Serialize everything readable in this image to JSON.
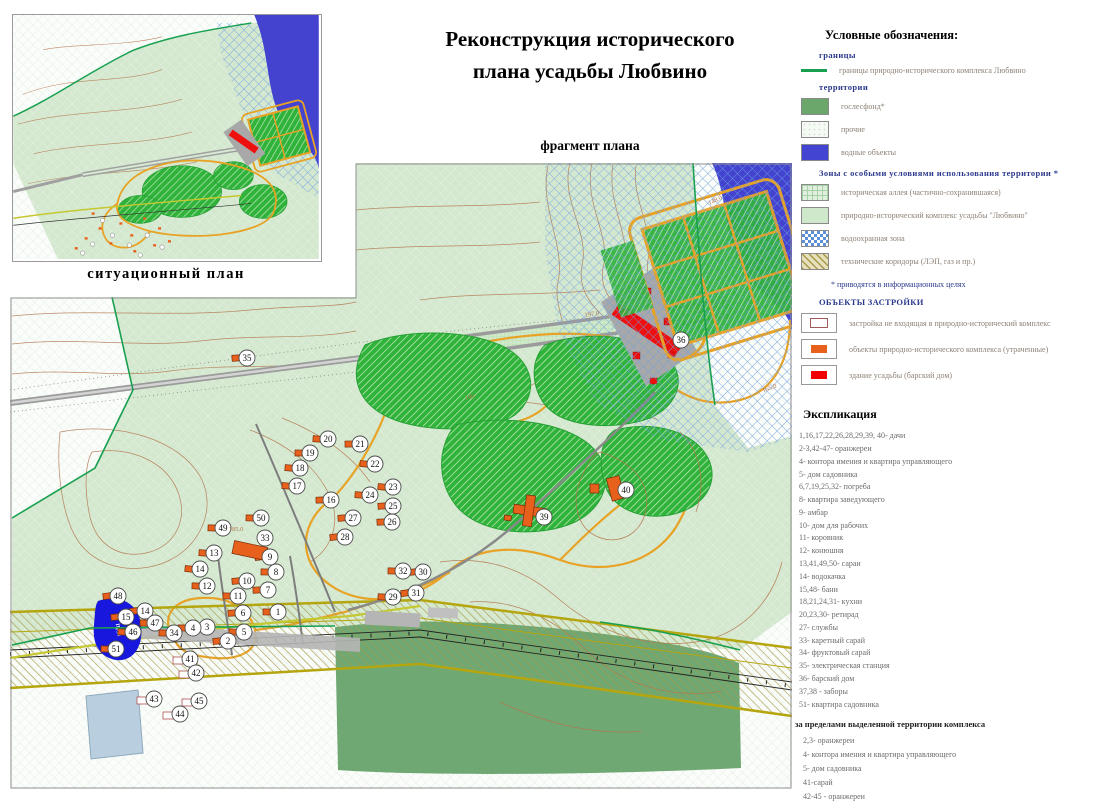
{
  "title": {
    "line1": "Реконструкция исторического",
    "line2": "плана усадьбы Любвино"
  },
  "fragment_label": "фрагмент плана",
  "inset": {
    "caption": "ситуационный план"
  },
  "legend": {
    "title": "Условные обозначения:",
    "sections": [
      {
        "heading": "границы",
        "items": [
          {
            "swatch": "line-green",
            "label": "границы природно-исторического комплекса Любвино"
          }
        ]
      },
      {
        "heading": "территории",
        "items": [
          {
            "swatch": "solid-green",
            "label": "гослесфонд*"
          },
          {
            "swatch": "dotted-white",
            "label": "прочие"
          },
          {
            "swatch": "solid-blue",
            "label": "водные объекты"
          }
        ]
      },
      {
        "heading": "Зоны с особыми условиями использования территории *",
        "items": [
          {
            "swatch": "grid-lightgreen",
            "label": "историческая аллея (частично-сохранившаяся)"
          },
          {
            "swatch": "solid-lightgreen",
            "label": "природно-исторический комплекс усадьбы \"Любвино\""
          },
          {
            "swatch": "checker-blue",
            "label": "водоохранная зона"
          },
          {
            "swatch": "hatch-olive",
            "label": "технические коридоры (ЛЭП, газ и пр.)"
          }
        ]
      }
    ],
    "note": "*   приводятся в информационных целях",
    "objects_heading": "ОБЪЕКТЫ ЗАСТРОЙКИ",
    "objects": [
      {
        "swatch": "box-outline",
        "label": "застройка не входящая в природно-исторический комплекс"
      },
      {
        "swatch": "box-orange",
        "label": "объекты природно-исторического комплекса (утраченные)"
      },
      {
        "swatch": "box-red",
        "label": "здание усадьбы (барский дом)"
      }
    ]
  },
  "explication": {
    "title": "Экспликация",
    "items": [
      "1,16,17,22,26,28,29,39, 40- дачи",
      "2-3,42-47-  оранжереи",
      "4- контора имения и квартира управляющего",
      "5- дом садовника",
      "6,7,19,25,32- погреба",
      "8- квартира заведующего",
      "9- амбар",
      "10- дом для рабочих",
      "11- коровник",
      "12- конюшня",
      "13,41,49,50- сараи",
      "14-  водокачка",
      "15,48- бани",
      "18,21,24,31- кухни",
      "20,23,30- ретирад",
      "27- службы",
      "33- каретный сарай",
      "34- фруктовый сарай",
      "35- электрическая станция",
      "36- барский дом",
      "37,38 - заборы",
      "51- квартира садовника"
    ],
    "outside_heading": "за пределами выделенной территории комплекса",
    "outside_items": [
      "2,3- оранжереи",
      "4- контора имения и квартира управляющего",
      "5- дом садовника",
      "41-сарай",
      "42-45 - оранжереи"
    ]
  },
  "map": {
    "pond_label": "Пруд",
    "contour_labels": [
      {
        "t": "197.0",
        "x": 592,
        "y": 316,
        "r": -8
      },
      {
        "t": "148.0",
        "x": 716,
        "y": 202,
        "r": -25
      },
      {
        "t": "165.0",
        "x": 770,
        "y": 390,
        "r": -20
      },
      {
        "t": "185.0",
        "x": 236,
        "y": 531,
        "r": 0
      },
      {
        "t": "190",
        "x": 470,
        "y": 399,
        "r": -10
      }
    ],
    "markers": [
      {
        "n": "1",
        "x": 278,
        "y": 612
      },
      {
        "n": "2",
        "x": 228,
        "y": 641
      },
      {
        "n": "3",
        "x": 207,
        "y": 627
      },
      {
        "n": "4",
        "x": 193,
        "y": 628
      },
      {
        "n": "5",
        "x": 244,
        "y": 632
      },
      {
        "n": "6",
        "x": 243,
        "y": 613
      },
      {
        "n": "7",
        "x": 268,
        "y": 590
      },
      {
        "n": "8",
        "x": 276,
        "y": 572
      },
      {
        "n": "9",
        "x": 270,
        "y": 557
      },
      {
        "n": "10",
        "x": 247,
        "y": 581
      },
      {
        "n": "11",
        "x": 238,
        "y": 596
      },
      {
        "n": "12",
        "x": 207,
        "y": 586
      },
      {
        "n": "13",
        "x": 214,
        "y": 553
      },
      {
        "n": "14",
        "x": 200,
        "y": 569
      },
      {
        "n": "14",
        "x": 145,
        "y": 611
      },
      {
        "n": "15",
        "x": 126,
        "y": 617
      },
      {
        "n": "16",
        "x": 331,
        "y": 500
      },
      {
        "n": "17",
        "x": 297,
        "y": 486
      },
      {
        "n": "18",
        "x": 300,
        "y": 468
      },
      {
        "n": "19",
        "x": 310,
        "y": 453
      },
      {
        "n": "20",
        "x": 328,
        "y": 439
      },
      {
        "n": "21",
        "x": 360,
        "y": 444
      },
      {
        "n": "22",
        "x": 375,
        "y": 464
      },
      {
        "n": "23",
        "x": 393,
        "y": 487
      },
      {
        "n": "24",
        "x": 370,
        "y": 495
      },
      {
        "n": "25",
        "x": 393,
        "y": 506
      },
      {
        "n": "26",
        "x": 392,
        "y": 522
      },
      {
        "n": "27",
        "x": 353,
        "y": 518
      },
      {
        "n": "28",
        "x": 345,
        "y": 537
      },
      {
        "n": "29",
        "x": 393,
        "y": 597
      },
      {
        "n": "30",
        "x": 423,
        "y": 572
      },
      {
        "n": "31",
        "x": 416,
        "y": 593
      },
      {
        "n": "32",
        "x": 403,
        "y": 571
      },
      {
        "n": "33",
        "x": 265,
        "y": 538,
        "b": "n"
      },
      {
        "n": "34",
        "x": 174,
        "y": 633
      },
      {
        "n": "35",
        "x": 247,
        "y": 358
      },
      {
        "n": "36",
        "x": 681,
        "y": 340,
        "b": "n"
      },
      {
        "n": "39",
        "x": 544,
        "y": 517,
        "b": "n"
      },
      {
        "n": "40",
        "x": 626,
        "y": 490,
        "b": "n"
      },
      {
        "n": "41",
        "x": 190,
        "y": 659,
        "b": "w"
      },
      {
        "n": "42",
        "x": 196,
        "y": 673,
        "b": "w"
      },
      {
        "n": "43",
        "x": 154,
        "y": 699,
        "b": "w"
      },
      {
        "n": "44",
        "x": 180,
        "y": 714,
        "b": "w"
      },
      {
        "n": "45",
        "x": 199,
        "y": 701,
        "b": "w"
      },
      {
        "n": "46",
        "x": 133,
        "y": 632
      },
      {
        "n": "47",
        "x": 155,
        "y": 623
      },
      {
        "n": "48",
        "x": 118,
        "y": 596
      },
      {
        "n": "49",
        "x": 223,
        "y": 528
      },
      {
        "n": "50",
        "x": 261,
        "y": 518
      },
      {
        "n": "51",
        "x": 116,
        "y": 649
      }
    ]
  },
  "colors": {
    "accent_orange": "#e8a225",
    "building_orange": "#e8611c",
    "estate_red": "#ee0f0f",
    "water_blue": "#4343d0",
    "forest_green": "#2fb33b",
    "goslesfond_green": "#6fa873",
    "territory_green": "#d3e8ce",
    "border_green": "#18a050",
    "corridor_olive": "#a89a4a",
    "contour_brown": "#b4764f"
  }
}
